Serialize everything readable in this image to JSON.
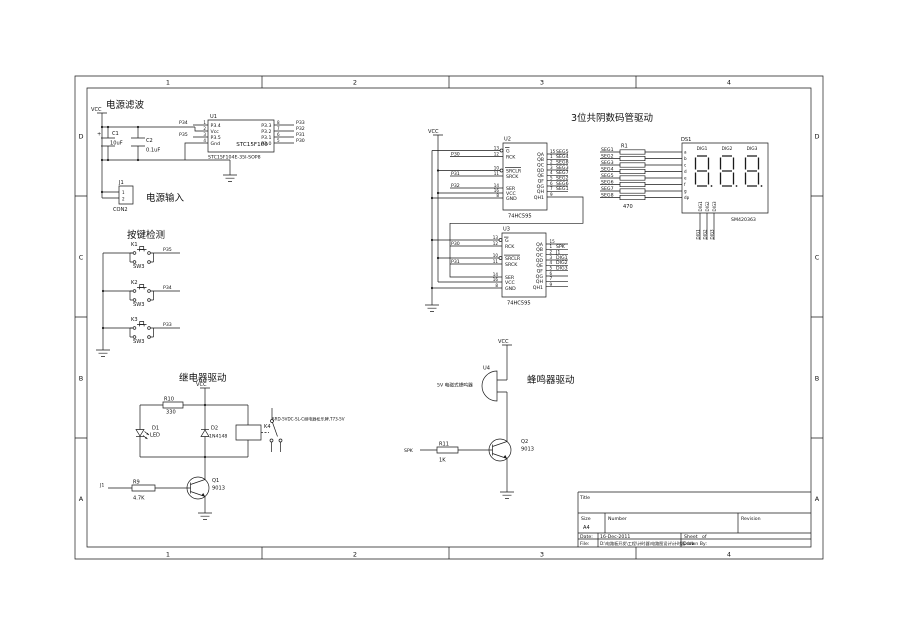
{
  "sheet": {
    "cols": [
      "1",
      "2",
      "3",
      "4"
    ],
    "rows": [
      "D",
      "C",
      "B",
      "A"
    ]
  },
  "labels": {
    "vcc": "VCC"
  },
  "power": {
    "title": "电源滤波",
    "input_label": "电源输入",
    "c1": {
      "ref": "C1",
      "value": "10uF",
      "polarity": "+"
    },
    "c2": {
      "ref": "C2",
      "value": "0.1uF"
    },
    "u1": {
      "ref": "U1",
      "name": "STC15F100",
      "part": "STC15F104E-35I-SOP8",
      "left": [
        {
          "num": "1",
          "name": "P3.4",
          "net": "P34"
        },
        {
          "num": "2",
          "name": "Vcc",
          "net": ""
        },
        {
          "num": "3",
          "name": "P3.5",
          "net": "P35"
        },
        {
          "num": "4",
          "name": "Gnd",
          "net": ""
        }
      ],
      "right": [
        {
          "num": "8",
          "name": "P3.3",
          "net": "P33"
        },
        {
          "num": "7",
          "name": "P3.2",
          "net": "P32"
        },
        {
          "num": "6",
          "name": "P3.1",
          "net": "P31"
        },
        {
          "num": "5",
          "name": "P3.0",
          "net": "P30"
        }
      ]
    },
    "j1": {
      "ref": "J1",
      "part": "CON2",
      "pin1": "1",
      "pin2": "2"
    }
  },
  "keys": {
    "title": "按键检测",
    "sw": [
      {
        "ref": "K1",
        "part": "SW3",
        "net": "P35"
      },
      {
        "ref": "K2",
        "part": "SW3",
        "net": "P34"
      },
      {
        "ref": "K3",
        "part": "SW3",
        "net": "P33"
      }
    ]
  },
  "relay": {
    "title": "继电器驱动",
    "r10": {
      "ref": "R10",
      "value": "330"
    },
    "d1": {
      "ref": "D1",
      "value": "LED"
    },
    "d2": {
      "ref": "D2",
      "value": "1N4148"
    },
    "k4": {
      "ref": "K4",
      "note": "SRD-5VDC-SL-C继电器松乐牌,T73-5V"
    },
    "q1": {
      "ref": "Q1",
      "value": "9013"
    },
    "r9": {
      "ref": "R9",
      "value": "4.7K",
      "net": "J1"
    }
  },
  "seg": {
    "title": "3位共阴数码管驱动",
    "u2": {
      "ref": "U2",
      "part": "74HC595",
      "left": [
        {
          "num": "13",
          "name": "G",
          "net": ""
        },
        {
          "num": "12",
          "name": "RCK",
          "net": "P30"
        },
        {
          "num": "10",
          "name": "SRCLR",
          "net": ""
        },
        {
          "num": "11",
          "name": "SRCK",
          "net": "P31"
        },
        {
          "num": "14",
          "name": "SER",
          "net": "P32"
        },
        {
          "num": "16",
          "name": "VCC",
          "net": ""
        },
        {
          "num": "8",
          "name": "GND",
          "net": ""
        }
      ],
      "right": [
        {
          "num": "15",
          "name": "QA",
          "net": "SEG5"
        },
        {
          "num": "1",
          "name": "QB",
          "net": "SEG4"
        },
        {
          "num": "2",
          "name": "QC",
          "net": "SEG8"
        },
        {
          "num": "3",
          "name": "QD",
          "net": "SEG3"
        },
        {
          "num": "4",
          "name": "QE",
          "net": "SEG7"
        },
        {
          "num": "5",
          "name": "QF",
          "net": "SEG2"
        },
        {
          "num": "6",
          "name": "QG",
          "net": "SEG6"
        },
        {
          "num": "7",
          "name": "QH",
          "net": "SEG1"
        },
        {
          "num": "9",
          "name": "QH1",
          "net": ""
        }
      ]
    },
    "u3": {
      "ref": "U3",
      "part": "74HC595",
      "left": [
        {
          "num": "13",
          "name": "G",
          "net": ""
        },
        {
          "num": "12",
          "name": "RCK",
          "net": "P30"
        },
        {
          "num": "10",
          "name": "SRCLR",
          "net": ""
        },
        {
          "num": "11",
          "name": "SRCK",
          "net": "P31"
        },
        {
          "num": "14",
          "name": "SER",
          "net": ""
        },
        {
          "num": "16",
          "name": "VCC",
          "net": ""
        },
        {
          "num": "8",
          "name": "GND",
          "net": ""
        }
      ],
      "right": [
        {
          "num": "15",
          "name": "QA",
          "net": ""
        },
        {
          "num": "1",
          "name": "QB",
          "net": "SPK"
        },
        {
          "num": "2",
          "name": "QC",
          "net": "J1"
        },
        {
          "num": "3",
          "name": "QD",
          "net": "DIG1"
        },
        {
          "num": "4",
          "name": "QE",
          "net": "DIG2"
        },
        {
          "num": "5",
          "name": "QF",
          "net": "DIG3"
        },
        {
          "num": "6",
          "name": "QG",
          "net": ""
        },
        {
          "num": "7",
          "name": "QH",
          "net": ""
        },
        {
          "num": "9",
          "name": "QH1",
          "net": ""
        }
      ]
    },
    "r1": {
      "ref": "R1",
      "value": "470",
      "nets": [
        "SEG1",
        "SEG2",
        "SEG3",
        "SEG4",
        "SEG5",
        "SEG6",
        "SEG7",
        "SEG8"
      ]
    },
    "ds1": {
      "ref": "DS1",
      "part": "SM420363",
      "digits": [
        "DIG1",
        "DIG2",
        "DIG3"
      ],
      "pins": [
        "a",
        "b",
        "c",
        "d",
        "e",
        "f",
        "g",
        "dp"
      ],
      "bottom": [
        "DIG1",
        "DIG2",
        "DIG3"
      ],
      "bottom_nets": [
        "DIG1",
        "DIG2",
        "DIG3"
      ]
    }
  },
  "buzzer": {
    "title": "蜂鸣器驱动",
    "u4": {
      "ref": "U4",
      "note": "5V 电磁式蜂鸣器"
    },
    "q2": {
      "ref": "Q2",
      "value": "9013"
    },
    "r11": {
      "ref": "R11",
      "value": "1K",
      "net": "SPK"
    }
  },
  "tb": {
    "title": "Title",
    "size": "Size",
    "size_v": "A4",
    "number": "Number",
    "revision": "Revision",
    "date": "Date:",
    "date_v": "16-Dec-2011",
    "sheet": "Sheet",
    "of": "of",
    "file": "File:",
    "file_v": "D:\\电路板开发\\工程\\计时器\\电路图设计\\计时器.ddb",
    "drawn": "Drawn By:"
  }
}
